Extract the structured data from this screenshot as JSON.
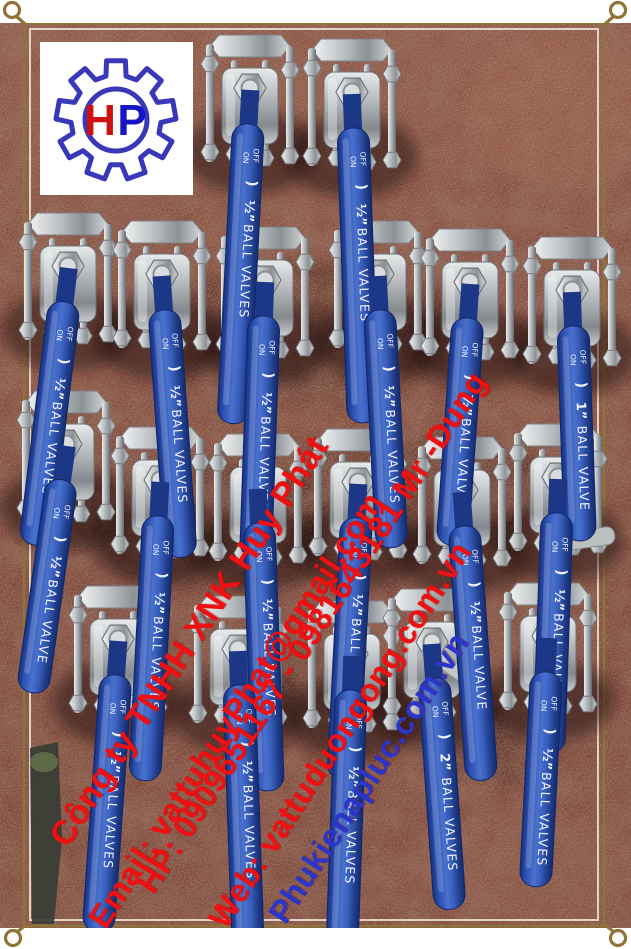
{
  "photo": {
    "subject": "stainless steel 3-piece ball valves with blue lever handles arranged in rows on a red-brown stone floor"
  },
  "logo": {
    "letter_h": "H",
    "letter_p": "P"
  },
  "watermark": {
    "angle_deg": -57,
    "lines": [
      {
        "text": "Công ty TNHH XNK Huy Phát",
        "color": "#ef1111",
        "x": 75,
        "y": 792,
        "size": 34
      },
      {
        "text": "Email: vattuhuyPhat@gmail.com",
        "color": "#ef1111",
        "x": 112,
        "y": 875,
        "size": 32
      },
      {
        "text": "HP: 0909651167 - 0981643181 Mr -Dung",
        "color": "#ef1111",
        "x": 160,
        "y": 840,
        "size": 32
      },
      {
        "text": "Web: vattuduongong.com.vn",
        "color": "#ef1111",
        "x": 232,
        "y": 875,
        "size": 32
      },
      {
        "text": "Phukienapluc.com.vn",
        "color": "#2a35cc",
        "x": 292,
        "y": 870,
        "size": 32
      }
    ]
  },
  "handle_labels": {
    "on": "ON",
    "off": "OFF",
    "arrow": ")"
  },
  "valves": [
    {
      "x": 250,
      "y": 34,
      "rot": 3,
      "len": 300,
      "size": "½”",
      "name": "BALL VALVES"
    },
    {
      "x": 352,
      "y": 38,
      "rot": -2,
      "len": 295,
      "size": "½”",
      "name": "BALL VALVES"
    },
    {
      "x": 68,
      "y": 212,
      "rot": 7,
      "len": 245,
      "size": "½”",
      "name": "BALL VALVES"
    },
    {
      "x": 162,
      "y": 220,
      "rot": -4,
      "len": 248,
      "size": "½”",
      "name": "BALL VALVES"
    },
    {
      "x": 265,
      "y": 226,
      "rot": 2,
      "len": 242,
      "size": "½”",
      "name": "BALL VALVES"
    },
    {
      "x": 378,
      "y": 220,
      "rot": -3,
      "len": 238,
      "size": "½”",
      "name": "BALL VALVES"
    },
    {
      "x": 470,
      "y": 228,
      "rot": 4,
      "len": 228,
      "size": "½”",
      "name": "BALL VALVES"
    },
    {
      "x": 572,
      "y": 236,
      "rot": -2,
      "len": 215,
      "size": "1”",
      "name": "BALL VALVE"
    },
    {
      "x": 66,
      "y": 390,
      "rot": 8,
      "len": 215,
      "size": "½”",
      "name": "BALL VALVE"
    },
    {
      "x": 160,
      "y": 426,
      "rot": 3,
      "len": 265,
      "size": "½”",
      "name": "BALL VALVES"
    },
    {
      "x": 258,
      "y": 433,
      "rot": -2,
      "len": 268,
      "size": "½”",
      "name": "BALL VALVES"
    },
    {
      "x": 358,
      "y": 428,
      "rot": 3,
      "len": 262,
      "size": "½”",
      "name": "BALL VALVES"
    },
    {
      "x": 462,
      "y": 436,
      "rot": -4,
      "len": 255,
      "size": "½”",
      "name": "BALL VALVE"
    },
    {
      "x": 558,
      "y": 423,
      "rot": 2,
      "len": 240,
      "size": "½”",
      "name": "BALL VALVES"
    },
    {
      "x": 118,
      "y": 585,
      "rot": 4,
      "len": 258,
      "size": "½”",
      "name": "BALL VALVES"
    },
    {
      "x": 238,
      "y": 595,
      "rot": -2,
      "len": 262,
      "size": "½”",
      "name": "BALL VALVES"
    },
    {
      "x": 352,
      "y": 600,
      "rot": 2,
      "len": 268,
      "size": "½”",
      "name": "BALL VALVES"
    },
    {
      "x": 432,
      "y": 588,
      "rot": -4,
      "len": 232,
      "size": "2”",
      "name": "BALL VALVES"
    },
    {
      "x": 548,
      "y": 582,
      "rot": 3,
      "len": 215,
      "size": "½”",
      "name": "BALL VALVES"
    }
  ],
  "colors": {
    "watermark_red": "#ef1111",
    "watermark_blue": "#2a35cc",
    "handle_blue": "#2d52b4",
    "frame_gold": "#8f7337",
    "frame_line": "#efe8da",
    "floor_brown": "#82493a",
    "logo_red": "#d01010",
    "logo_blue": "#1616c8",
    "gear_blue": "#3838b8"
  }
}
